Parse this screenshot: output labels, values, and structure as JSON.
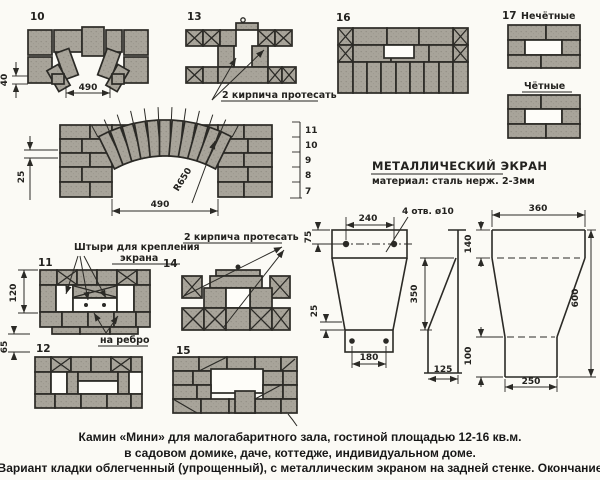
{
  "drawings": {
    "d10": {
      "num": "10",
      "dim_height": "40",
      "dim_width": "490"
    },
    "d13": {
      "num": "13",
      "note": "2 кирпича протесать"
    },
    "d16": {
      "num": "16"
    },
    "d17": {
      "num": "17",
      "odd_label": "Нечётные",
      "even_label": "Чётные"
    },
    "arch": {
      "radius": "R650",
      "dim_width": "490",
      "dim_joint": "25",
      "row_numbers": [
        "11",
        "10",
        "9",
        "8",
        "7"
      ]
    },
    "d11": {
      "num": "11",
      "pins_note_line1": "Штыри для крепления",
      "pins_note_line2": "экрана",
      "edge_note": "на ребро",
      "dim_height": "120",
      "dim_gap": "65"
    },
    "d12": {
      "num": "12"
    },
    "d14": {
      "num": "14",
      "note": "2 кирпича протесать"
    },
    "d15": {
      "num": "15"
    }
  },
  "screen": {
    "title": "МЕТАЛЛИЧЕСКИЙ ЭКРАН",
    "material": "материал: сталь нерж. 2-3мм",
    "front": {
      "dim_width": "240",
      "holes_note": "4 отв. ø10",
      "dim_top": "75",
      "dim_lip": "25",
      "dim_height": "350",
      "dim_bottom_width": "180",
      "dim_offset": "125"
    },
    "side": {
      "dim_width": "360",
      "dim_top": "140",
      "dim_height": "600",
      "dim_bottom": "100",
      "dim_bottom_width": "250"
    }
  },
  "caption": {
    "line1": "Камин «Мини» для малогабаритного зала, гостиной площадью 12-16 кв.м.",
    "line2": "в садовом домике, даче, коттедже, индивидуальном доме.",
    "line3": "Вариант кладки облегченный (упрощенный), с металлическим экраном на задней стенке. Окончание"
  }
}
